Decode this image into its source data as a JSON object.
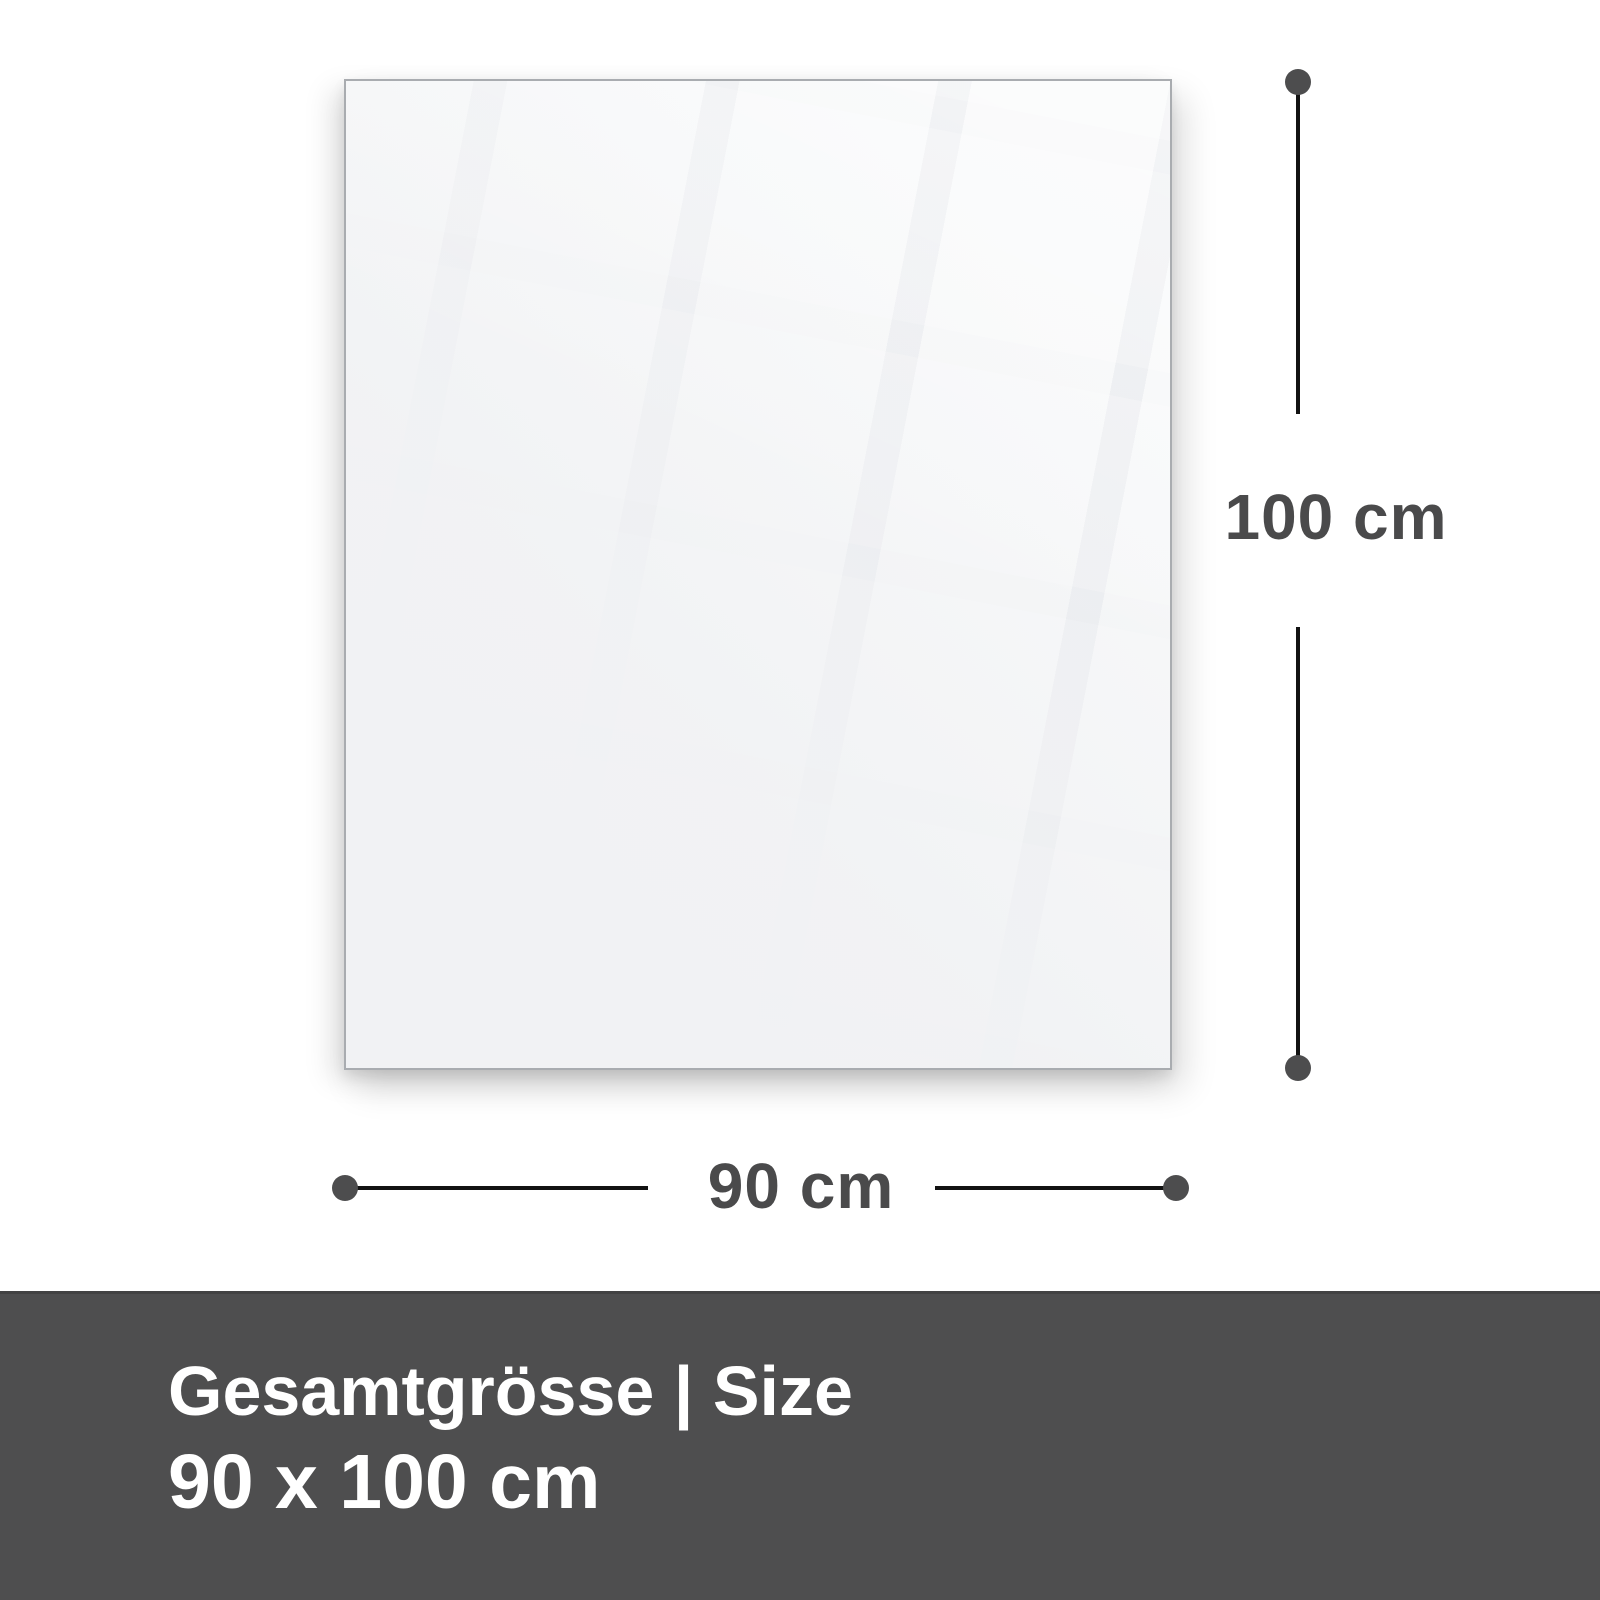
{
  "panel": {
    "description": "blank glass pane with faint tiled window reflection"
  },
  "dimensions": {
    "height": {
      "label": "100 cm"
    },
    "width": {
      "label": "90 cm"
    }
  },
  "banner": {
    "title": "Gesamtgrösse | Size",
    "size": "90 x 100 cm"
  },
  "colors": {
    "background": "#ffffff",
    "panel_fill": "#f1f2f4",
    "panel_border": "#a9acb0",
    "dimension_line": "#121212",
    "dimension_dot": "#4d4d4e",
    "dimension_text": "#4a4a4b",
    "banner_background": "#4e4e4f",
    "banner_text": "#ffffff"
  }
}
